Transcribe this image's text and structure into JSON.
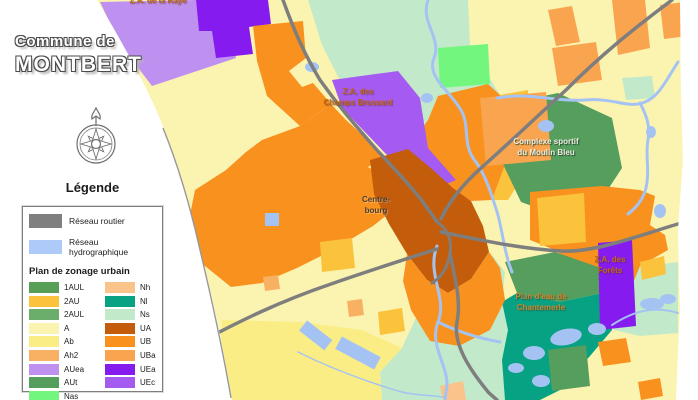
{
  "title": {
    "line1": "Commune de",
    "line2": "MONTBERT"
  },
  "legend": {
    "heading": "Légende",
    "network": [
      {
        "label": "Réseau routier",
        "color": "#7F7F7F"
      },
      {
        "label": "Réseau hydrographique",
        "color": "#AECAF8"
      }
    ],
    "zoning_heading": "Plan de zonage urbain",
    "col1": [
      {
        "code": "1AUL",
        "color": "#579E57"
      },
      {
        "code": "2AU",
        "color": "#FBC23B"
      },
      {
        "code": "2AUL",
        "color": "#6BAE6B"
      },
      {
        "code": "A",
        "color": "#FBF4B1"
      },
      {
        "code": "Ab",
        "color": "#FBED85"
      },
      {
        "code": "Ah2",
        "color": "#F8B163"
      },
      {
        "code": "AUea",
        "color": "#BE90F0"
      },
      {
        "code": "AUt",
        "color": "#569E5E"
      },
      {
        "code": "Nas",
        "color": "#72F67E"
      }
    ],
    "col2": [
      {
        "code": "Nh",
        "color": "#FAC38B"
      },
      {
        "code": "Nl",
        "color": "#07A183"
      },
      {
        "code": "Ns",
        "color": "#C2EACA"
      },
      {
        "code": "UA",
        "color": "#C35D0C"
      },
      {
        "code": "UB",
        "color": "#F9911E"
      },
      {
        "code": "UBa",
        "color": "#F9A44F"
      },
      {
        "code": "UEa",
        "color": "#861BF0"
      },
      {
        "code": "UEc",
        "color": "#A55BF2"
      }
    ]
  },
  "map": {
    "colors": {
      "A": "#FBF4B1",
      "Ab": "#FBED85",
      "Ah2": "#F8B163",
      "AUea": "#BE90F0",
      "AUt": "#569E5E",
      "Nas": "#72F67E",
      "Nh": "#FAC38B",
      "Nl": "#07A183",
      "Ns": "#C2EACA",
      "UA": "#C35D0C",
      "UB": "#F9911E",
      "UBa": "#F9A44F",
      "UEa": "#861BF0",
      "UEc": "#A55BF2",
      "2AU": "#FBC23B",
      "road": "#7E7E7E",
      "water": "#A5C3F2",
      "boundary": "#989898"
    },
    "labels": [
      {
        "id": "za-de-la-raye",
        "text": "Z.A. de la Raye",
        "color": "#C0651A"
      },
      {
        "id": "za-des-champs-brossard",
        "text": "Z.A. des\nChamps Brossard",
        "color": "#C0651A"
      },
      {
        "id": "centre-bourg",
        "text": "Centre-\nbourg",
        "color": "#4A3E2E"
      },
      {
        "id": "complexe-sportif",
        "text": "Complexe sportif\ndu Moulin Bleu",
        "color": "#EFEDE2"
      },
      {
        "id": "za-des-forets",
        "text": "Z.A. des\nForêts",
        "color": "#C0651A"
      },
      {
        "id": "plan-deau",
        "text": "Plan d'eau de\nChantemerle",
        "color": "#CE8430"
      }
    ]
  }
}
